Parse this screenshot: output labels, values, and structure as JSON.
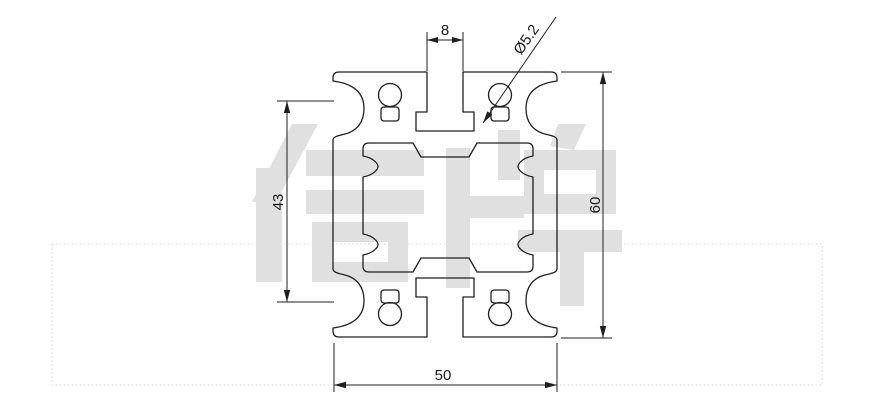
{
  "watermark": {
    "text": "信牌",
    "color": "#e0e0e0"
  },
  "dimensions": {
    "top_slot_width": "8",
    "hole_diameter": "Ø5.2",
    "left_inner_height": "43",
    "overall_height": "60",
    "overall_width": "50"
  },
  "colors": {
    "background": "#ffffff",
    "line": "#1f1f1f",
    "dotted_box": "#d8d8d8"
  }
}
